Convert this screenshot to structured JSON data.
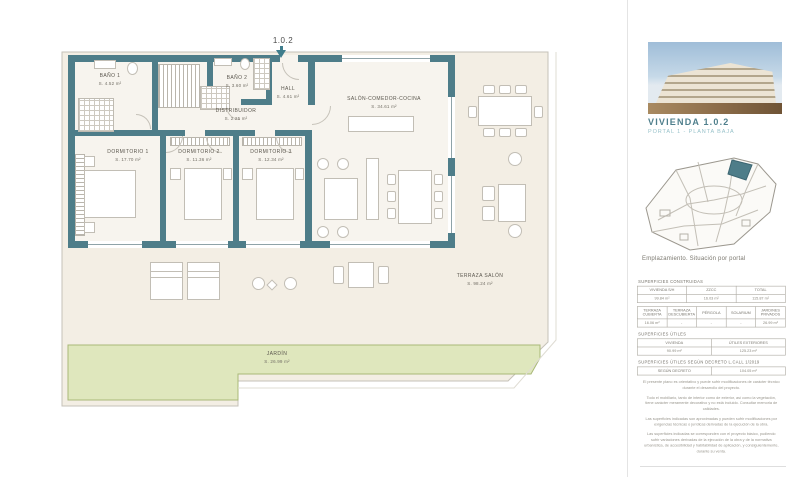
{
  "unit_label": "1.0.2",
  "plan": {
    "rooms": [
      {
        "name": "BAÑO 1",
        "area": "S. 4.52 m²"
      },
      {
        "name": "BAÑO 2",
        "area": "S. 3.60 m²"
      },
      {
        "name": "HALL",
        "area": "S. 4.61 m²"
      },
      {
        "name": "DISTRIBUIDOR",
        "area": "S. 2.25 m²"
      },
      {
        "name": "DORMITORIO 1",
        "area": "S. 17.70 m²"
      },
      {
        "name": "DORMITORIO 2",
        "area": "S. 11.36 m²"
      },
      {
        "name": "DORMITORIO 3",
        "area": "S. 12.34 m²"
      },
      {
        "name": "SALÓN-COMEDOR-COCINA",
        "area": "S. 34.61 m²"
      },
      {
        "name": "TERRAZA SALÓN",
        "area": "S. 98.24 m²"
      },
      {
        "name": "JARDÍN",
        "area": "S. 26.99 m²"
      }
    ]
  },
  "sidebar": {
    "title": "VIVIENDA  1.0.2",
    "subtitle": "PORTAL 1 - PLANTA BAJA",
    "map_caption": "Emplazamiento. Situación por portal",
    "sections": {
      "constructed_title": "SUPERFICIES CONSTRUIDAS",
      "useful_title": "SUPERFICIES ÚTILES",
      "decree_title": "SUPERFICIES ÚTILES SEGÚN DECRETO L.CALL 1/2019"
    },
    "tables": {
      "constructed": {
        "headers": [
          "VIVIENDA S/H",
          "ZZCC",
          "TOTAL"
        ],
        "values": [
          "99.84 m²",
          "16.03 m²",
          "115.87 m²"
        ]
      },
      "exterior": {
        "headers": [
          "TERRAZA CUBIERTA",
          "TERRAZA DESCUBIERTA",
          "PÉRGOLA",
          "SOLARIUM",
          "JARDINES PRIVADOS"
        ],
        "values": [
          "16.06 m²",
          "-",
          "-",
          "-",
          "26.99 m²"
        ]
      },
      "useful": {
        "headers": [
          "VIVIENDA",
          "ÚTILES EXTERIORES"
        ],
        "values": [
          "90.99 m²",
          "125.23 m²"
        ]
      },
      "decree": {
        "headers": [
          "SEGÚN DECRETO"
        ],
        "values": [
          "104.05 m²"
        ]
      }
    },
    "disclaimers": [
      "El presente plano es orientativo y puede sufrir modificaciones de carácter técnico durante el desarrollo del proyecto.",
      "Todo el mobiliario, tanto de interior como de exterior, así como la vegetación, tiene carácter meramente decorativo y no está incluido. Consultar memoria de calidades.",
      "Las superficies indicadas son aproximadas y pueden sufrir modificaciones por exigencias técnicas o jurídicas derivadas de la ejecución de la obra.",
      "Las superficies indicadas se corresponden con el proyecto básico, pudiendo sufrir variaciones derivadas de la ejecución de la obra y de la normativa urbanística, de accesibilidad y habitabilidad de aplicación, y consiguientemente, durante su venta."
    ]
  },
  "colors": {
    "wall": "#4e7d89",
    "terrace": "#f3eee4",
    "garden": "#dfe7bd",
    "accent_teal": "#4f7f8c"
  }
}
